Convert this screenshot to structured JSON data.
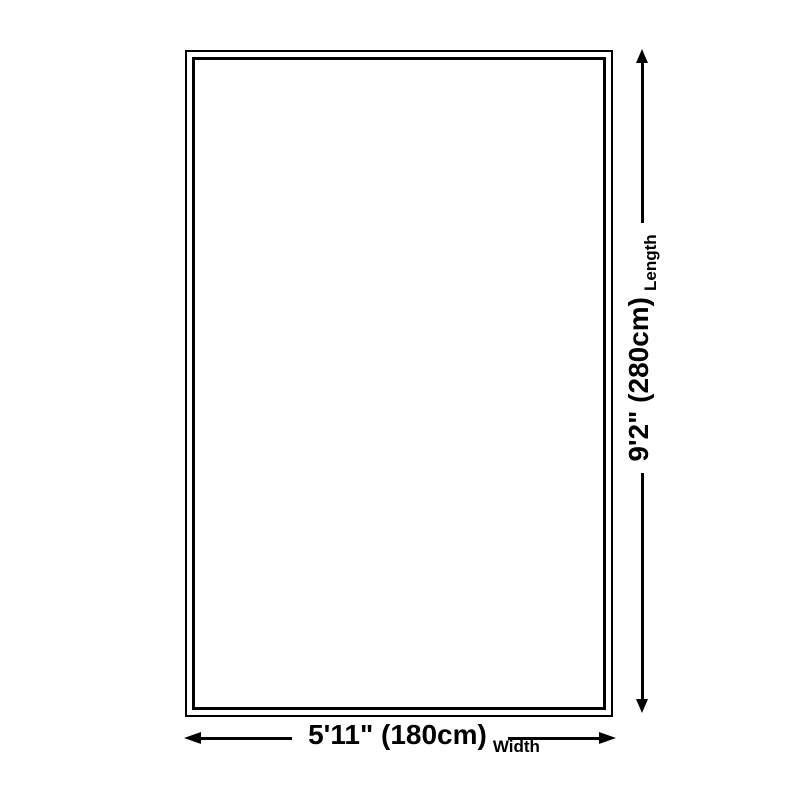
{
  "canvas": {
    "background": "#ffffff",
    "line_color": "#000000"
  },
  "dimensions": {
    "length": {
      "value": "9'2\" (280cm)",
      "label": "Length",
      "orientation": "vertical"
    },
    "width": {
      "value": "5'11\" (180cm)",
      "label": "Width",
      "orientation": "horizontal"
    }
  },
  "icons": {
    "arrow_up": "triangle-up",
    "arrow_down": "triangle-down",
    "arrow_left": "triangle-left",
    "arrow_right": "triangle-right"
  }
}
